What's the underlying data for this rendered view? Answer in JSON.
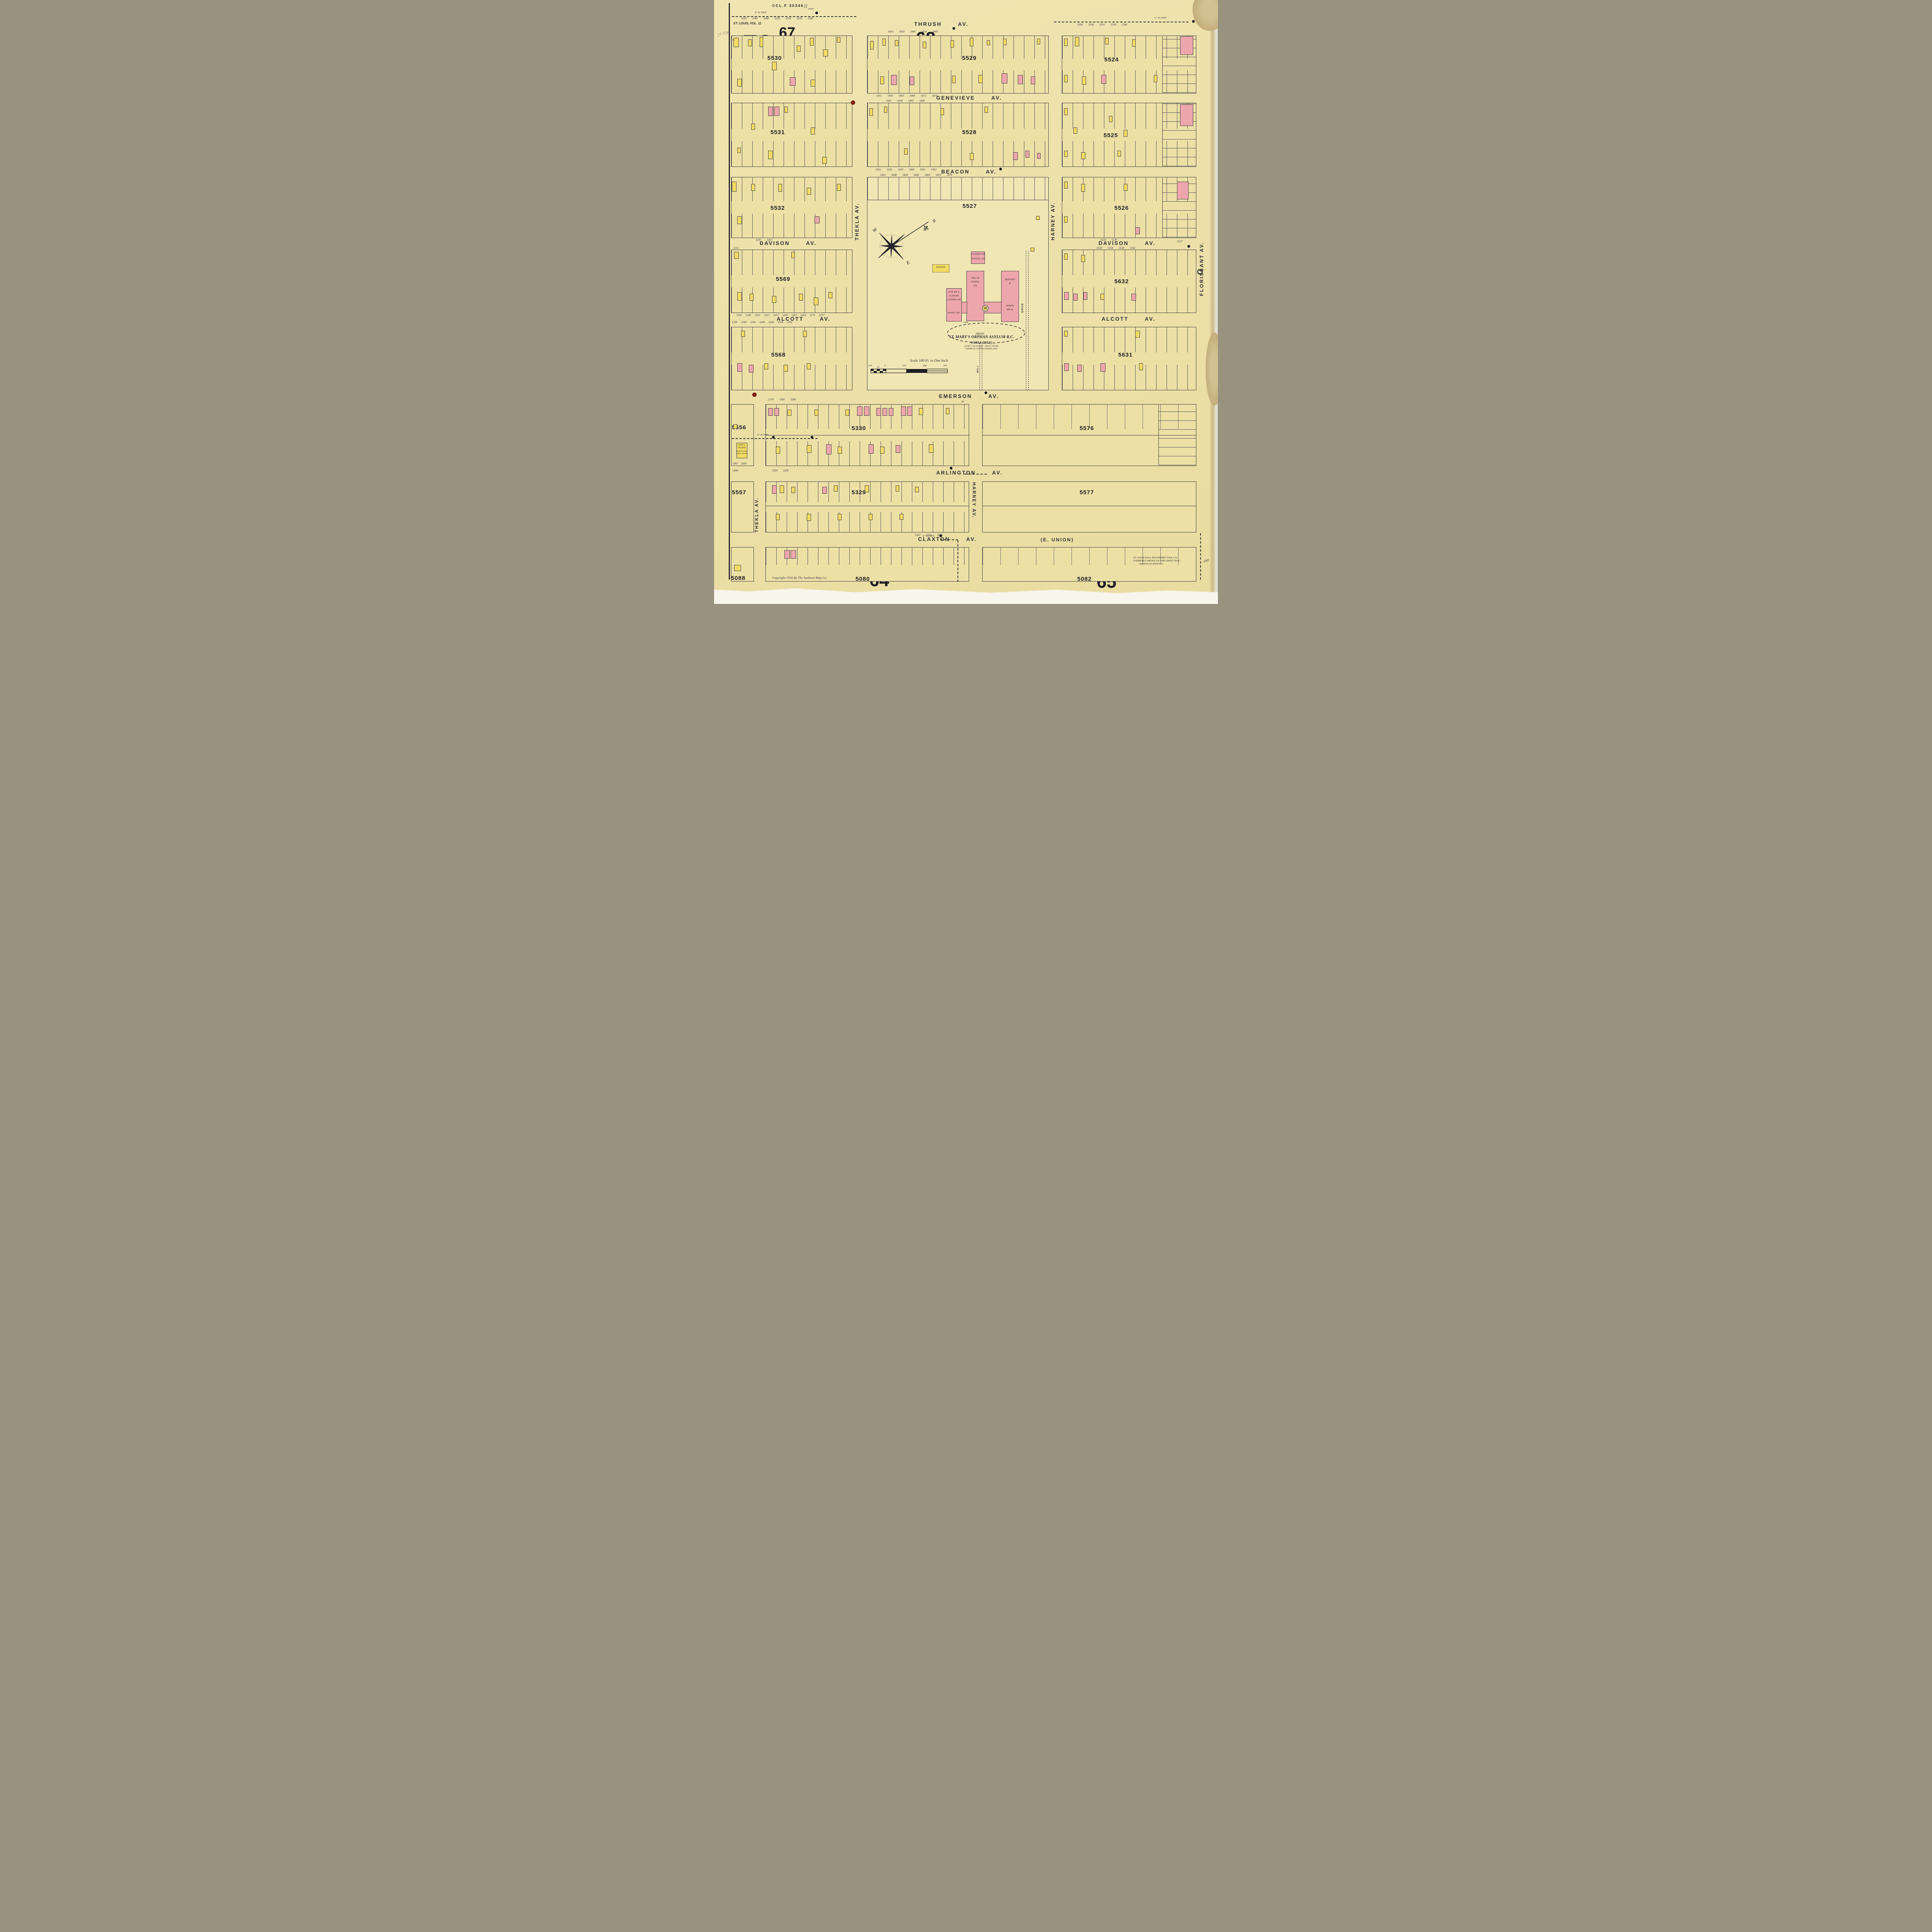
{
  "sheet": {
    "number": "73",
    "label_new_sheet": "NEW SHEET",
    "label_date": "OCT. 1916.",
    "scale_note": "SCALE 100 FT TO AN INCH.",
    "stamp": "©CL.F 30346",
    "volume": "ST. LOUIS, VOL. 11",
    "pencil_note": "27-726",
    "pencil_initial": "R"
  },
  "adjacent_sheets": {
    "nw": "67",
    "n": "68",
    "ne": "70",
    "w": "126",
    "s": "64",
    "se": "65"
  },
  "streets": {
    "thrush": {
      "name": "THRUSH",
      "suffix": "AV."
    },
    "genevieve": {
      "name": "GENEVIEVE",
      "suffix": "AV."
    },
    "beacon": {
      "name": "BEACON",
      "suffix": "AV."
    },
    "davison_w": {
      "name": "DAVISON",
      "suffix": "AV."
    },
    "davison_e": {
      "name": "DAVISON",
      "suffix": "AV."
    },
    "alcott_w": {
      "name": "ALCOTT",
      "suffix": "AV."
    },
    "alcott_e": {
      "name": "ALCOTT",
      "suffix": "AV."
    },
    "emerson": {
      "name": "EMERSON",
      "suffix": "AV."
    },
    "arlington": {
      "name": "ARLINGTON",
      "suffix": "AV."
    },
    "claxton": {
      "name": "CLAXTON",
      "suffix": "AV.",
      "alt": "(E. UNION)"
    },
    "thekla_n": "THEKLA AV.",
    "thekla_s": "THEKLA AV.",
    "harney_n": "HARNEY AV.",
    "harney_s": "HARNEY AV.",
    "florissant": "FLORISSANT AV.",
    "florissant_o": "O"
  },
  "blocks": {
    "r1w": "5530",
    "r1c": "5529",
    "r1e": "5524",
    "r2w": "5531",
    "r2c": "5528",
    "r2e": "5525",
    "r3w": "5532",
    "r3c": "5527",
    "r3e": "5526",
    "r4w": "5569",
    "r4e": "5632",
    "r5w": "5568",
    "r5e": "5631",
    "r6w": "5556",
    "r6c": "5330",
    "r6e": "5576",
    "r7w": "5557",
    "r7c": "5329",
    "r7e": "5577",
    "r8w": "5088",
    "r8c": "5080",
    "r8e": "5082"
  },
  "asylum": {
    "title": "ST. MARY'S ORPHAN ASYLUM R.C.",
    "subtitle": "(GIRLS ONLY)",
    "util1": "LIGHT: GAS & ELEC - HEAT: STEAM.",
    "util2": "CHEMICAL EXTINGUISHERS DIST.",
    "hall1": "HALL &",
    "hall2": "CHAPEL",
    "hall3": "1ST.",
    "kitchen1": "KITCHEN",
    "kitchen2": "B.",
    "dining1": "DINING",
    "dining2": "RM. B.",
    "play": "PLAY RM. B.",
    "classrm": "CLASS RM.",
    "clothing": "CLOTHING RM.",
    "sewing": "SEWING 2ND.",
    "laundry": "LAUNDRY R'MS",
    "hospital": "HOSPITAL 2ND",
    "pavilion": "PAVILION",
    "drive": "DRIVE.",
    "drive_v": "DRIVE",
    "gate": "GATE",
    "well": "WELL",
    "bldg_no": "35"
  },
  "scalebar": {
    "title": "Scale 100 Ft. to One Inch.",
    "ticks": [
      "100",
      "50",
      "0",
      "100",
      "200",
      "300"
    ]
  },
  "notes": {
    "copyright": "Copyright 1916 By The Sanborn Map Co.",
    "relocated1": "ST. LOUIS WELL MACHINERY TOOL CO.",
    "relocated2": "FORMERLY SHOWN ON THIS SHEET NOW",
    "relocated3": "SHOWN ON SHEET 15",
    "church1": "EPISC'L",
    "church2": "CHURCH.",
    "church3": "LIGHTS: ELEC.",
    "church4": "HEAT: STOVE",
    "pipe6": "6\" W. PIPE",
    "pipec": "C\" W. PIPE",
    "hyd": "HYD.",
    "d100": "100'",
    "d60": "60'",
    "d15": "15"
  },
  "compass": {
    "n": "N",
    "w": "W",
    "e": "E"
  },
  "addresses": {
    "thrush_w": "5230 5240 5248 5250 5254 5256 5260",
    "thrush_c": "5416 5430 5446 5454 5460",
    "thrush_e": "5506 5508 5516 5530 5540",
    "genevieve_n": "5431 5449 5467 5469 5473 5479",
    "genevieve_s": "5432 5434 5442 5458",
    "beacon_n": "5431 5435 5439 5449 5451 5453",
    "beacon_s": "5432 5448 5458 5460 5466 5472 5476",
    "davison_w_n": "5247 5267",
    "davison_w_s": "5232",
    "davison_e_n": "5533 5539",
    "davison_e_far": "5557",
    "davison_e_s": "5520 5528 5538 5542",
    "alcott_w_n": "5241 5245 5251 5253 5257 5259 5267 5269 5271 5277",
    "alcott_w_s": "5238 5240 5244 5248 5250 5254 5256",
    "emerson_s": "5376 5380 5388",
    "claxton_n": "5367 5375 5383",
    "bottom_w1": "5097 5099",
    "bottom_w2": "5094",
    "bottom_w3": "5300 5306"
  }
}
